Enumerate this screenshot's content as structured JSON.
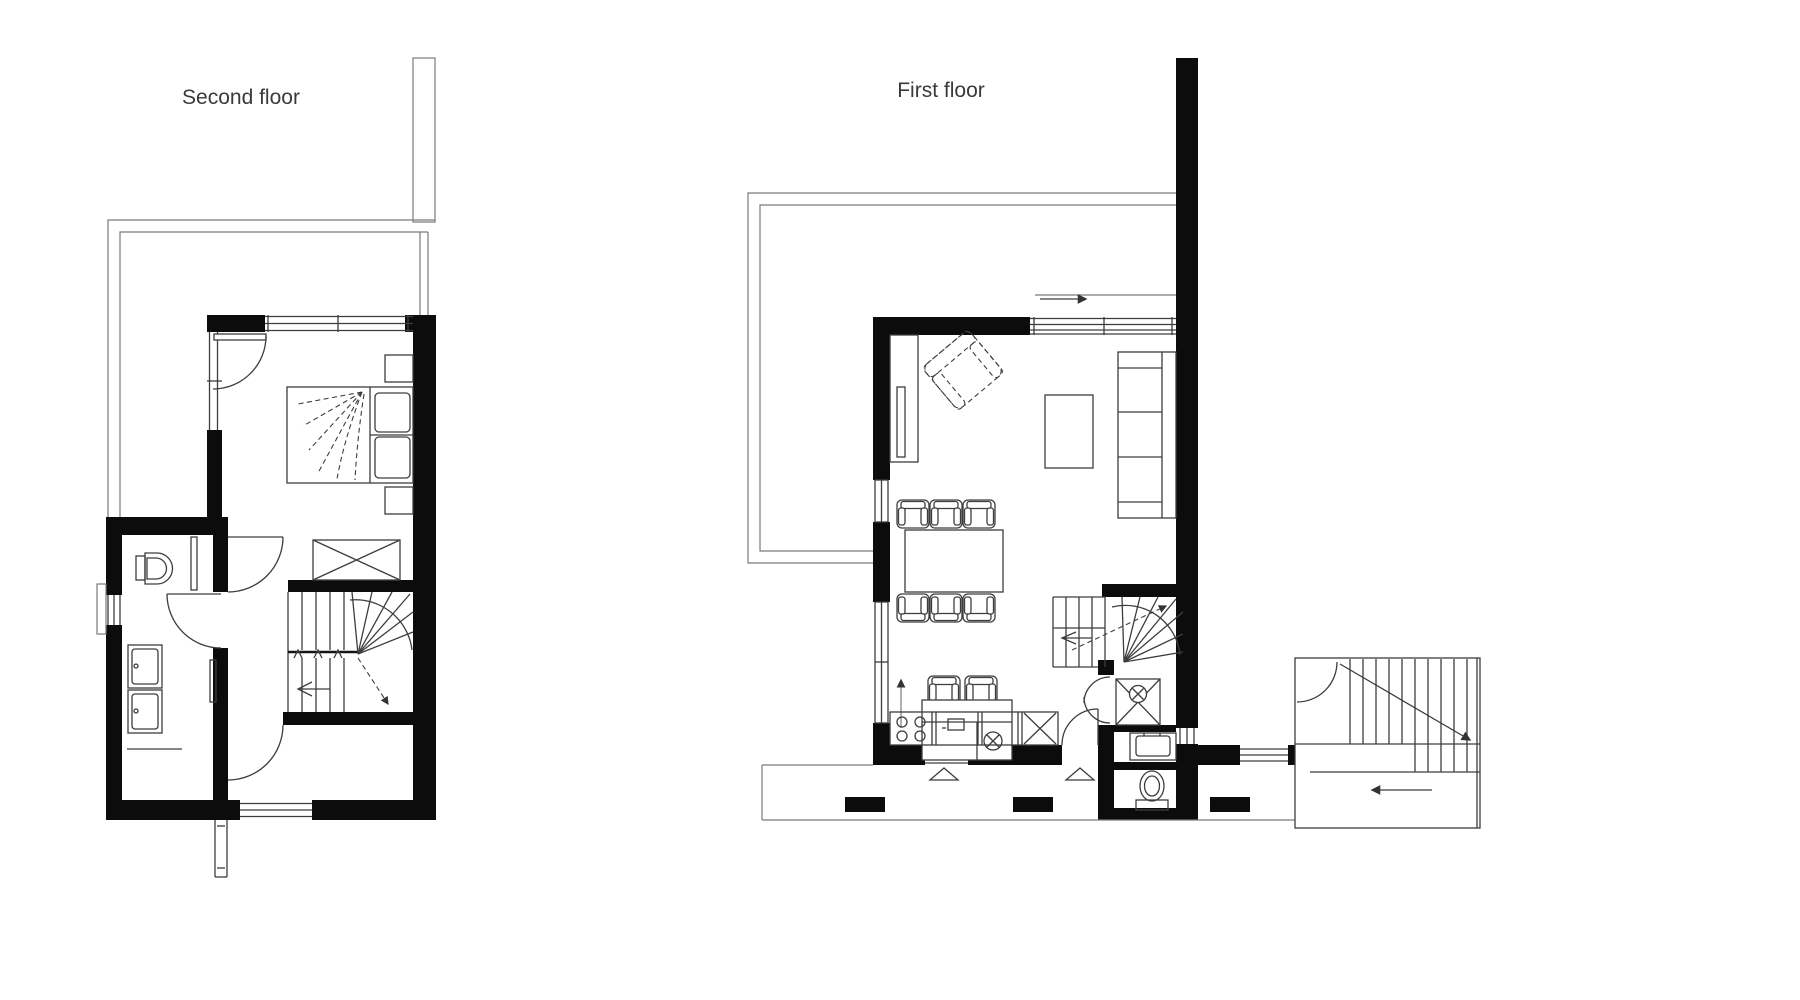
{
  "page": {
    "background": "#ffffff"
  },
  "palette": {
    "wall": "#0c0c0c",
    "line": "#3d3d3d",
    "thin_line": "#7a7a7a",
    "label": "#3a3a3a"
  },
  "plans": {
    "second_floor": {
      "label": "Second floor",
      "features": [
        "terrace-outline",
        "chimney",
        "bedroom",
        "double-bed",
        "nightstand",
        "wardrobe-cross",
        "winder-staircase",
        "direction-arrows",
        "bathroom",
        "toilet",
        "double-washbasin",
        "radiator",
        "hallway",
        "door-swings",
        "windows",
        "lower-room"
      ]
    },
    "first_floor": {
      "label": "First floor",
      "features": [
        "terrace-outline",
        "party-wall",
        "living-room",
        "closet",
        "radiator",
        "armchair",
        "coffee-table",
        "sofa",
        "dining-table",
        "dining-chairs",
        "kitchen-island",
        "bar-stools",
        "island-sink",
        "kitchen-counter",
        "cooktop",
        "dishwasher-cross",
        "winder-staircase",
        "direction-arrows",
        "entrance-arrow",
        "shower",
        "washbasin",
        "wc",
        "bifold-door",
        "porch",
        "entrance-triangles",
        "porch-posts",
        "external-staircase",
        "windows",
        "doors"
      ]
    }
  }
}
